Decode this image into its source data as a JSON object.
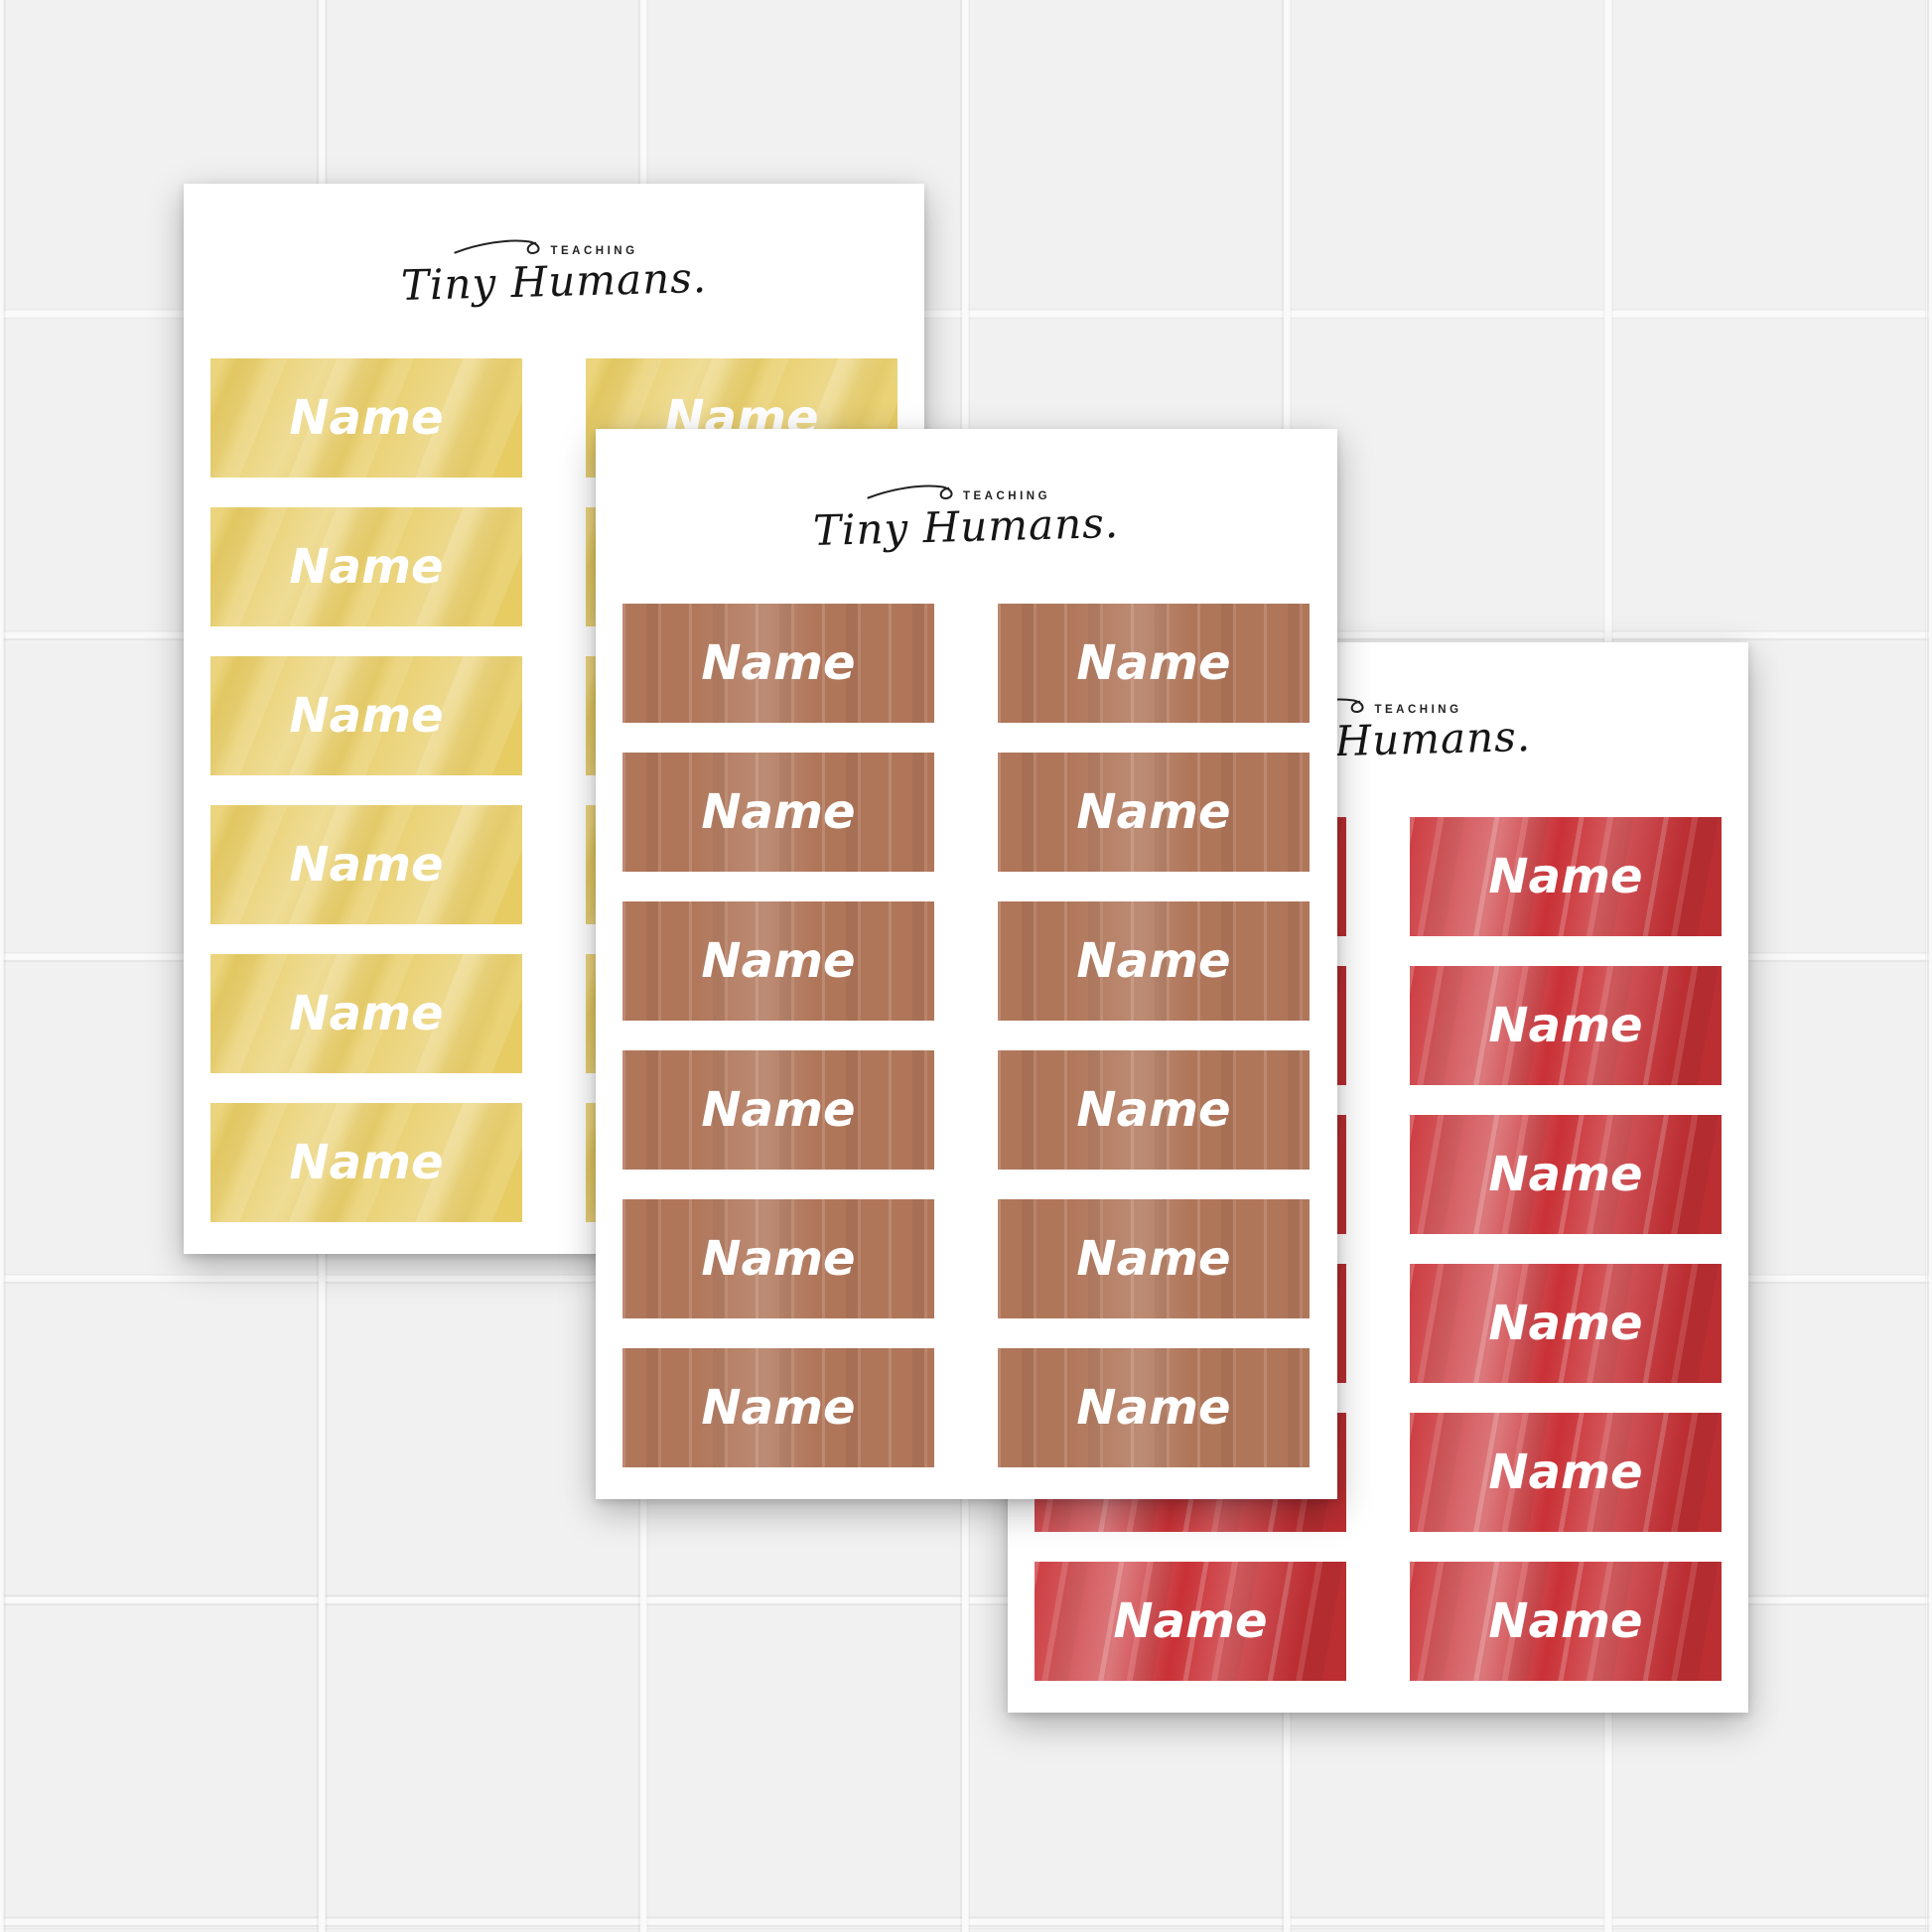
{
  "background": {
    "tile_color": "#f1f1f1",
    "grout_color": "#fafafa",
    "tile_size_px": 324
  },
  "brand": {
    "top": "TEACHING",
    "script": "Tiny Humans."
  },
  "label_text": "Name",
  "sheets": [
    {
      "name": "yellow",
      "label_color": "#e7cc64",
      "rows": 6,
      "columns": 2,
      "labels": [
        "Name",
        "Name",
        "Name",
        "Name",
        "Name",
        "Name",
        "Name",
        "Name",
        "Name",
        "Name",
        "Name",
        "Name"
      ]
    },
    {
      "name": "red",
      "label_color": "#c93136",
      "rows": 6,
      "columns": 2,
      "labels": [
        "Name",
        "Name",
        "Name",
        "Name",
        "Name",
        "Name",
        "Name",
        "Name",
        "Name",
        "Name",
        "Name",
        "Name"
      ]
    },
    {
      "name": "brown",
      "label_color": "#b0765a",
      "rows": 6,
      "columns": 2,
      "labels": [
        "Name",
        "Name",
        "Name",
        "Name",
        "Name",
        "Name",
        "Name",
        "Name",
        "Name",
        "Name",
        "Name",
        "Name"
      ]
    }
  ]
}
